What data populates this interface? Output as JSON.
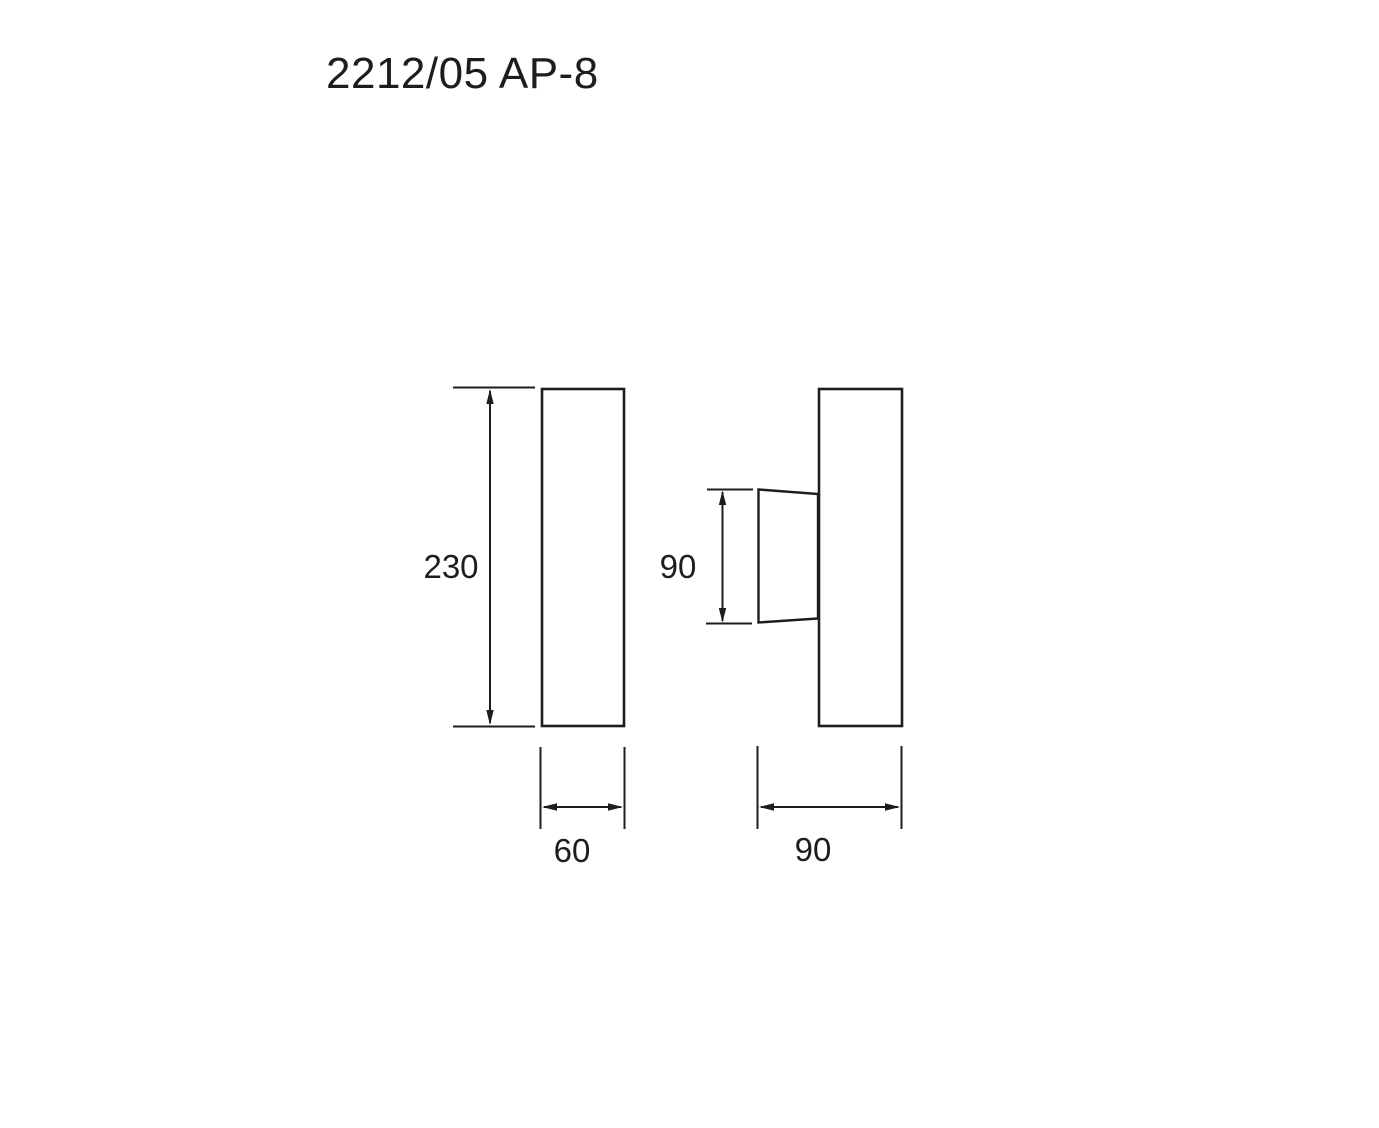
{
  "page": {
    "title": "2212/05 AP-8",
    "background_color": "#ffffff",
    "line_color": "#1d1d1b"
  },
  "drawing": {
    "type": "dimensioned-technical-drawing",
    "views": {
      "front": {
        "name": "front-view",
        "height_label": "230",
        "width_label": "60"
      },
      "side": {
        "name": "side-view",
        "bracket_height_label": "90",
        "width_label": "90"
      }
    }
  }
}
